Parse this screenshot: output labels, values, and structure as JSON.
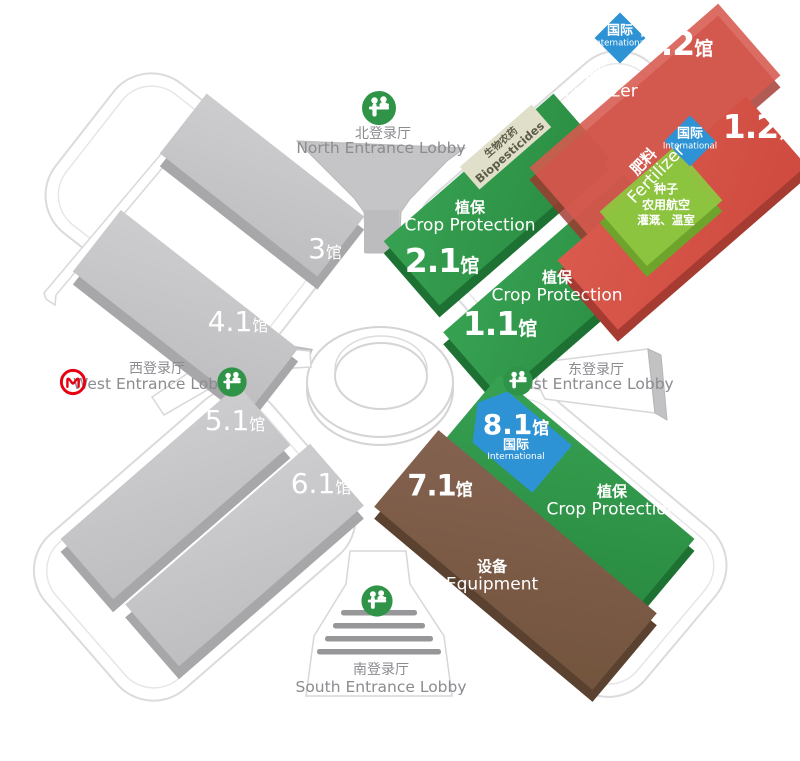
{
  "badge": {
    "zh": "国际",
    "en": "International"
  },
  "lobbies": {
    "north": {
      "zh": "北登录厅",
      "en": "North Entrance Lobby"
    },
    "east": {
      "zh": "东登录厅",
      "en": "East Entrance Lobby"
    },
    "west": {
      "zh": "西登录厅",
      "en": "West Entrance Lobby"
    },
    "south": {
      "zh": "南登录厅",
      "en": "South Entrance Lobby"
    }
  },
  "categories": {
    "crop": {
      "zh": "植保",
      "en": "Crop Protection"
    },
    "fert": {
      "zh": "肥料",
      "en": "Fertilizer"
    },
    "equip": {
      "zh": "设备",
      "en": "Equipment"
    },
    "bio": {
      "zh": "生物农药",
      "en": "Biopesticides"
    }
  },
  "seeds_block": {
    "line1": "种子",
    "line2": "农用航空",
    "line3": "灌溉、温室"
  },
  "halls": {
    "h22": {
      "num": "2.2",
      "suffix": "馆"
    },
    "h12": {
      "num": "1.2",
      "suffix": "馆"
    },
    "h21": {
      "num": "2.1",
      "suffix": "馆"
    },
    "h11": {
      "num": "1.1",
      "suffix": "馆"
    },
    "h81": {
      "num": "8.1",
      "suffix": "馆"
    },
    "h71": {
      "num": "7.1",
      "suffix": "馆"
    },
    "h3": {
      "num": "3",
      "suffix": "馆"
    },
    "h41": {
      "num": "4.1",
      "suffix": "馆"
    },
    "h51": {
      "num": "5.1",
      "suffix": "馆"
    },
    "h61": {
      "num": "6.1",
      "suffix": "馆"
    }
  },
  "colors": {
    "crop_protection_green": "#2e9447",
    "fertilizer_red": "#d4544a",
    "equipment_brown": "#7d5c44",
    "international_blue": "#2e93d4",
    "seeds_light_green": "#8ec640",
    "biopesticides_beige": "#e0dfca",
    "unused_hall_gray": "#c6c6c8",
    "metro_logo_red": "#e60012"
  }
}
